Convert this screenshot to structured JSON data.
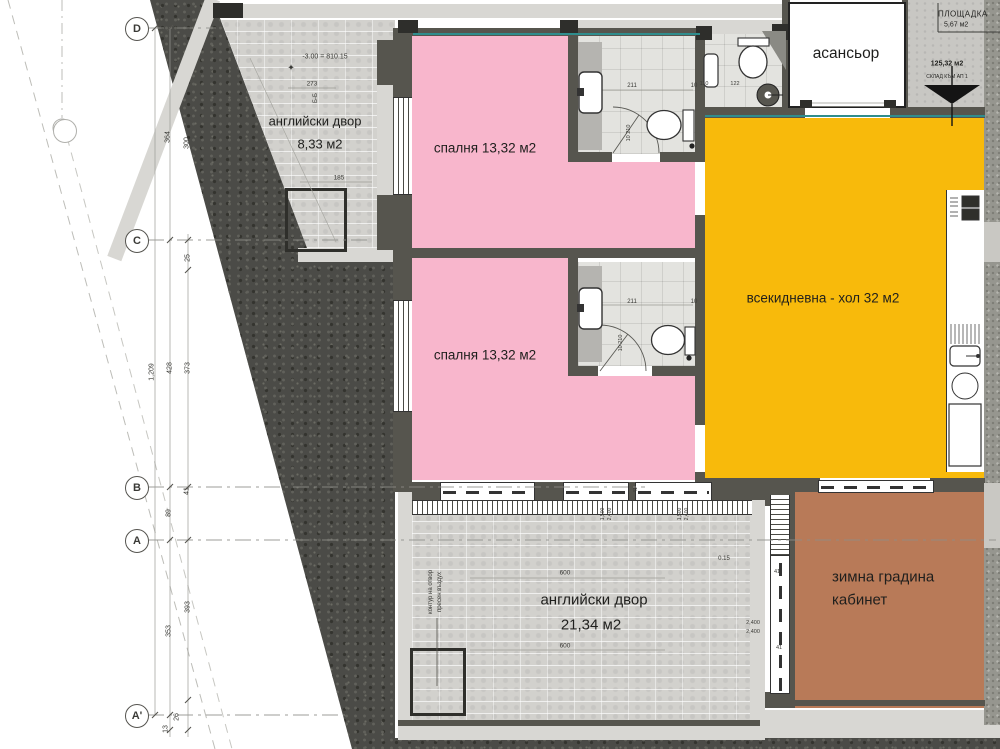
{
  "colors": {
    "bedroom": "#f8b6cc",
    "living": "#f8ba0b",
    "winter_garden": "#b87a58",
    "teal_line": "#2f8d8d",
    "soil": "#4b4b47"
  },
  "grid": {
    "d": "D",
    "c": "C",
    "b": "B",
    "a": "A",
    "a_prime": "A'"
  },
  "rooms": {
    "courtyard_upper": {
      "name": "английски двор",
      "area": "8,33 м2"
    },
    "bedroom_1": {
      "label": "спалня 13,32 м2"
    },
    "bedroom_2": {
      "label": "спалня 13,32 м2"
    },
    "living": {
      "label": "всекидневна - хол 32 м2"
    },
    "elevator": {
      "label": "асансьор"
    },
    "courtyard_lower": {
      "name": "английски двор",
      "area": "21,34 м2"
    },
    "winter_garden": {
      "line1": "зимна градина",
      "line2": "кабинет"
    },
    "landing": {
      "name": "ПЛОЩАДКА",
      "area": "5,67 м2"
    },
    "storage": {
      "area": "125,32 м2",
      "label": "СКЛАД КЪМ АП 1"
    }
  },
  "annotations": [
    {
      "t": "364",
      "x": 168,
      "y": 137,
      "r": 1
    },
    {
      "t": "300",
      "x": 187,
      "y": 143,
      "r": 1
    },
    {
      "t": "1,209",
      "x": 152,
      "y": 372,
      "r": 1
    },
    {
      "t": "428",
      "x": 170,
      "y": 368,
      "r": 1
    },
    {
      "t": "373",
      "x": 188,
      "y": 368,
      "r": 1
    },
    {
      "t": "25",
      "x": 188,
      "y": 258,
      "r": 1
    },
    {
      "t": "41",
      "x": 187,
      "y": 491,
      "r": 1
    },
    {
      "t": "89",
      "x": 169,
      "y": 513,
      "r": 1
    },
    {
      "t": "353",
      "x": 169,
      "y": 631,
      "r": 1
    },
    {
      "t": "393",
      "x": 188,
      "y": 607,
      "r": 1
    },
    {
      "t": "26",
      "x": 177,
      "y": 717,
      "r": 1
    },
    {
      "t": "13",
      "x": 166,
      "y": 729,
      "r": 1
    },
    {
      "t": "-3.00 = 810.15",
      "x": 325,
      "y": 57,
      "s": 7
    },
    {
      "t": "✦",
      "x": 291,
      "y": 68,
      "s": 9
    },
    {
      "t": "273",
      "x": 312,
      "y": 84,
      "s": 6.5
    },
    {
      "t": "Б-Б",
      "x": 316,
      "y": 98,
      "r": 1,
      "s": 6
    },
    {
      "t": "185",
      "x": 339,
      "y": 178,
      "s": 6.5
    },
    {
      "t": "211",
      "x": 632,
      "y": 86,
      "s": 6
    },
    {
      "t": "10",
      "x": 694,
      "y": 86,
      "s": 6
    },
    {
      "t": "10 210",
      "x": 629,
      "y": 133,
      "r": 1,
      "s": 5.5
    },
    {
      "t": "211",
      "x": 632,
      "y": 302,
      "s": 6
    },
    {
      "t": "10",
      "x": 694,
      "y": 302,
      "s": 6
    },
    {
      "t": "10 210",
      "x": 621,
      "y": 343,
      "r": 1,
      "s": 5.5
    },
    {
      "t": "110",
      "x": 704,
      "y": 84,
      "s": 5.5
    },
    {
      "t": "122",
      "x": 735,
      "y": 84,
      "s": 5.5
    },
    {
      "t": "600",
      "x": 565,
      "y": 573,
      "s": 6.5
    },
    {
      "t": "600",
      "x": 565,
      "y": 646,
      "s": 6.5
    },
    {
      "t": "0.15",
      "x": 724,
      "y": 559,
      "s": 6
    },
    {
      "t": "2,400",
      "x": 753,
      "y": 623,
      "s": 5.5
    },
    {
      "t": "2,400",
      "x": 753,
      "y": 632,
      "s": 5.5
    },
    {
      "t": "41",
      "x": 777,
      "y": 572,
      "s": 5.5
    },
    {
      "t": "41",
      "x": 779,
      "y": 648,
      "s": 5.5
    },
    {
      "t": "контур на отвор",
      "x": 431,
      "y": 592,
      "r": 1,
      "s": 6
    },
    {
      "t": "пресен въздух",
      "x": 440,
      "y": 592,
      "r": 1,
      "s": 6
    },
    {
      "t": "1,500",
      "x": 603,
      "y": 514,
      "r": 1,
      "s": 5
    },
    {
      "t": "2,400",
      "x": 610,
      "y": 514,
      "r": 1,
      "s": 5
    },
    {
      "t": "1,500",
      "x": 680,
      "y": 514,
      "r": 1,
      "s": 5
    },
    {
      "t": "2,400",
      "x": 687,
      "y": 514,
      "r": 1,
      "s": 5
    },
    {
      "t": "41",
      "x": 636,
      "y": 490,
      "r": 1,
      "s": 5
    }
  ]
}
